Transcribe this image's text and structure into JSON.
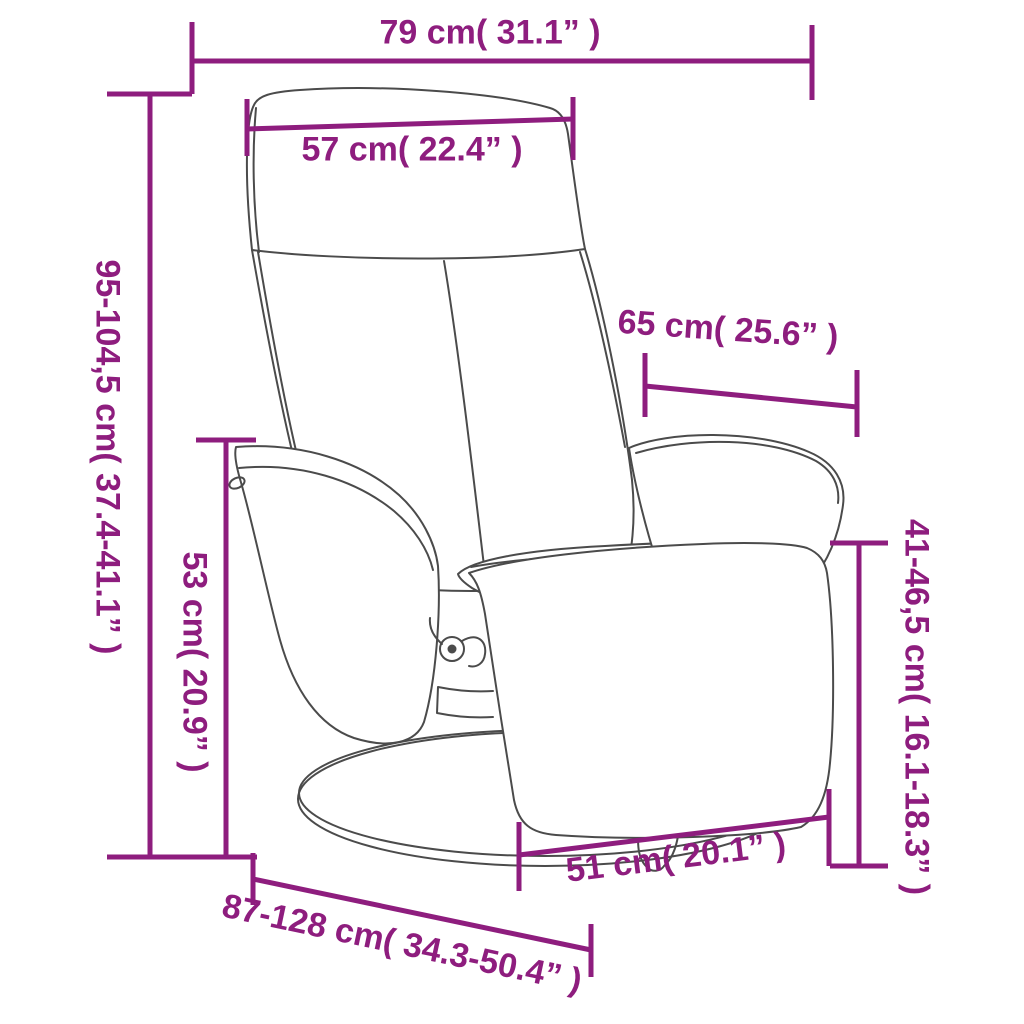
{
  "page": {
    "background_color": "#ffffff"
  },
  "diagram": {
    "accent_color": "#8e1d7e",
    "sketch_line_color": "#4b4b4b",
    "dimensions": {
      "overall_width": "79 cm( 31.1” )",
      "headrest_width": "57 cm( 22.4” )",
      "overall_height": "95-104,5 cm( 37.4-41.1” )",
      "backrest_depth": "65 cm( 25.6” )",
      "seat_height": "53 cm( 20.9” )",
      "footrest_height": "41-46,5 cm( 16.1-18.3” )",
      "seat_width": "51 cm( 20.1” )",
      "overall_depth": "87-128 cm( 34.3-50.4” )"
    }
  }
}
